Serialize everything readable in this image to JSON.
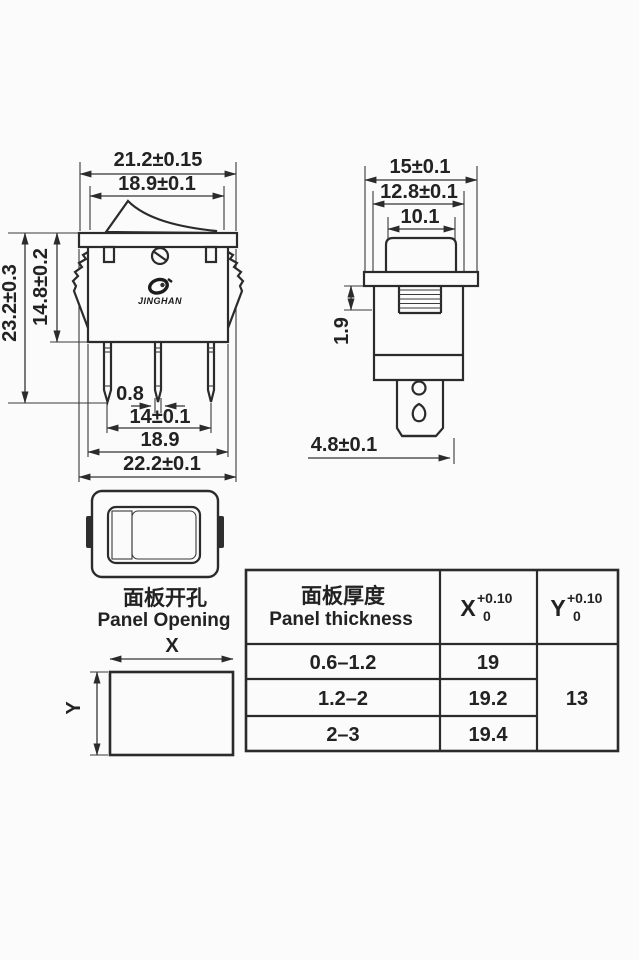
{
  "front_view": {
    "dim_flange_width_top": "21.2±0.15",
    "dim_rocker_width": "18.9±0.1",
    "dim_total_height": "23.2±0.3",
    "dim_body_height": "14.8±0.2",
    "dim_pin_thickness": "0.8",
    "dim_pin_pitch": "14±0.1",
    "dim_body_width": "18.9",
    "dim_flange_width_bottom": "22.2±0.1",
    "logo_text": "JINGHAN"
  },
  "side_view": {
    "dim_flange_depth": "15±0.1",
    "dim_body_depth": "12.8±0.1",
    "dim_rocker_depth": "10.1",
    "dim_snap_height": "1.9",
    "dim_terminal_width": "4.8±0.1"
  },
  "panel_opening": {
    "title_zh": "面板开孔",
    "title_en": "Panel Opening",
    "x_label": "X",
    "y_label": "Y"
  },
  "table": {
    "header_thickness_zh": "面板厚度",
    "header_thickness_en": "Panel thickness",
    "header_x_base": "X",
    "header_x_tol_plus": "+0.10",
    "header_x_tol_minus": "0",
    "header_y_base": "Y",
    "header_y_tol_plus": "+0.10",
    "header_y_tol_minus": "0",
    "rows": [
      {
        "thickness": "0.6–1.2",
        "x": "19"
      },
      {
        "thickness": "1.2–2",
        "x": "19.2"
      },
      {
        "thickness": "2–3",
        "x": "19.4"
      }
    ],
    "y_value": "13"
  },
  "colors": {
    "line": "#2b2b2b",
    "background": "#fbfbfb"
  }
}
